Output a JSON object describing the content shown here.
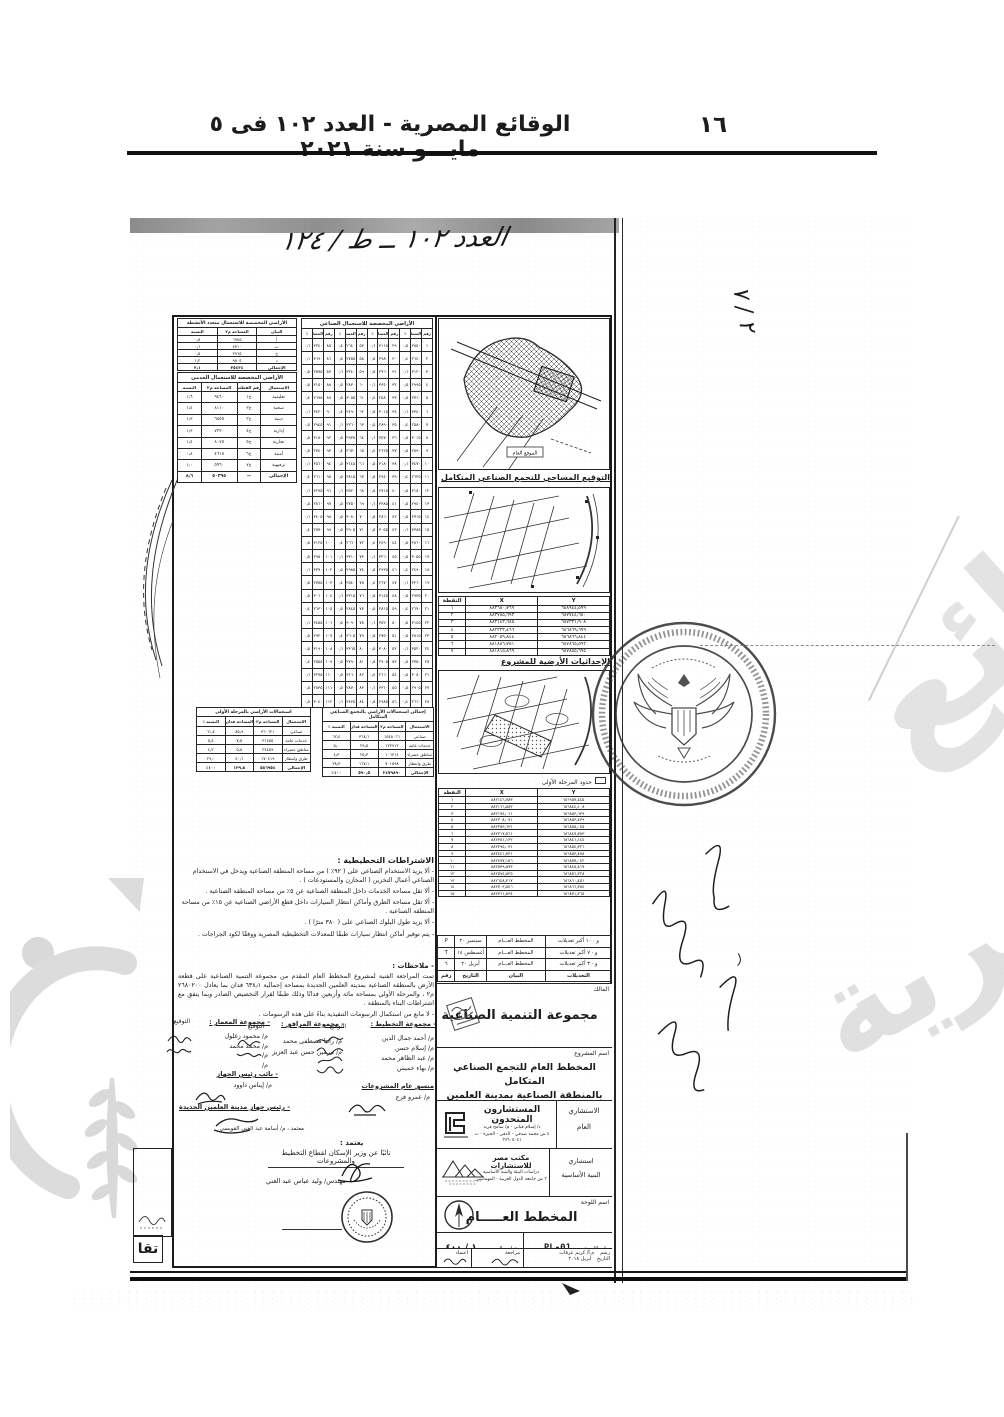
{
  "header": {
    "gazette_line": "الوقائع المصرية - العدد ١٠٢ فى ٥ مايـــو سنة ٢٠٢١",
    "page_number": "١٦"
  },
  "annotations": {
    "top_handwriting": "العدد ١٠٢ ــ ط / ١٢٤",
    "corner_mark": "٢ / ٧",
    "bottom_left_label": "تقا",
    "approved_note": "معتمد ، م/ أسامة عبد الغني القويسي"
  },
  "colors": {
    "ink": "#1c1c1c",
    "watermark": "#dedede",
    "scan_band": "#8e8e8e"
  },
  "maps": {
    "map1_caption": "التوقيع المساحي للتجمع الصناعي المتكامل",
    "map1_inner_label": "الموقع العام",
    "map2_caption": "الإحداثيات الأرضية للمشروع",
    "phase_label": "حدود المرحلة الأولى"
  },
  "coords_table1": {
    "widths": [
      "42",
      "42",
      "16"
    ],
    "headers": [
      "Y",
      "X",
      "النقطة"
    ],
    "rows": [
      [
        "٦٨٨٩٤٤٫٥٩٩",
        "٨٨٣٦٨٠٫٧٦٩",
        "١"
      ],
      [
        "٦٨٧٧٤٤٫٦٨٠",
        "٨٨٣٧٨٥٫٦٩٣",
        "٢"
      ],
      [
        "٦٨٧٣٣١٫٩٠٨",
        "٨٨٣١٤٣٫٦٨٥",
        "٣"
      ],
      [
        "٦٨٦٨٦٩٫٦٩٩",
        "٨٨٢٣٣٣٫٤٦٦",
        "٤"
      ],
      [
        "٦٨٦٨٦٦٫٨٤٤",
        "٨٨٢٠٥٩٫٨٤٤",
        "٥"
      ],
      [
        "٦٨٧٨٦٥٫٥٩٢",
        "٨٨١٨٨٦٫٧٥١",
        "٦"
      ],
      [
        "٦٨٧٨٥٥٫٦٩٥",
        "٨٨١٨١٥٫٨٦٩",
        "٧"
      ]
    ]
  },
  "coords_table2": {
    "widths": [
      "42",
      "42",
      "16"
    ],
    "headers": [
      "Y",
      "X",
      "النقطة"
    ],
    "rows": [
      [
        "٦٨٦٩٥٧٫٤٤٥",
        "٨٨٢١٤٦٫٧٨٣",
        "١"
      ],
      [
        "٦٨٦٨٤٤٫١٠٨",
        "٨٨٢١٦٦٫٥٨٢",
        "٢"
      ],
      [
        "٦٨٦٨٥٣٫٦٣٩",
        "٨٨٢١٧٤٫٠٦١",
        "٣"
      ],
      [
        "٦٨٦٨٥٣٫٤٣٩",
        "٨٨٢٢٠٨٫٠٧١",
        "٤"
      ],
      [
        "٦٨٦٨٥٥٫٠٤٥",
        "٨٨٢٢٥٣٫٦٣١",
        "٥"
      ],
      [
        "٦٨٦٨٤٧٫٧٨٣",
        "٨٨٢٣١٧٫٥٦١",
        "٦"
      ],
      [
        "٦٨٦٨٤٦٫١٤٤",
        "٨٨٢٣٥١٫١٣٢",
        "٧"
      ],
      [
        "٦٨٦٨٥٤٫٣٢٦",
        "٨٨٢٣٩٥٫٠٣١",
        "٨"
      ],
      [
        "٦٨٦٨٥٣٫٤٧٨",
        "٨٨٢٤٤١٫٧٣١",
        "٩"
      ],
      [
        "٦٨٦٨٥٧٫٠٤٢",
        "٨٨٢٤٧٧٫١٥٦",
        "١٠"
      ],
      [
        "٦٨٦٨٤٥٫٤١٧",
        "٨٨٢٥٣٩٫٨٧٣",
        "١١"
      ],
      [
        "٦٨٦٨٥٦٫٢٢٨",
        "٨٨٢٥٩٤٫٨٢٥",
        "١٢"
      ],
      [
        "٦٨٦٨٦٠٫٤٥١",
        "٨٨٢٦٤٨٫٣١٧",
        "١٣"
      ],
      [
        "٦٨٦٨٦٦٫٣٨٤",
        "٨٨٢٧٠٣٫٥٤٦",
        "١٤"
      ],
      [
        "٦٨٦٨٧١٫٢٦٥",
        "٨٨٢٧٦١٫٨٣٤",
        "١٥"
      ]
    ]
  },
  "industrial_table": {
    "title": "الأراضي المخصصة للاستعمال الصناعي",
    "headers": [
      "رقم",
      "المساحة",
      "٪",
      "رقم",
      "المساحة",
      "٪",
      "رقم",
      "المساحة",
      "٪",
      "رقم",
      "المساحة",
      "٪"
    ],
    "rows": [
      [
        "١",
        "٢٨٥٠",
        "٠٫٥",
        "٢٩",
        "٣١١٥",
        "٠٫٦",
        "٥٧",
        "٢٦٤٠",
        "٠٫٤",
        "٨٥",
        "٣٢٤٠",
        "٠٫٦"
      ],
      [
        "٢",
        "٢٦٤٠",
        "٠٫٤",
        "٣٠",
        "٢٩٨٠",
        "٠٫٥",
        "٥٨",
        "٢٧٥٥",
        "٠٫٥",
        "٨٦",
        "٣٦٩٠",
        "٠٫٦"
      ],
      [
        "٣",
        "٣١٢٠",
        "٠٫٦",
        "٣١",
        "٢٧٦٠",
        "٠٫٥",
        "٥٩",
        "٣٢٤٠",
        "٠٫٦",
        "٨٧",
        "٢٨٧٥",
        "٠٫٥"
      ],
      [
        "٤",
        "٢٩٩٥",
        "٠٫٥",
        "٣٢",
        "٣٣٤٠",
        "٠٫٦",
        "٦٠",
        "٢٨٣٠",
        "٠٫٥",
        "٨٨",
        "٣١٥٠",
        "٠٫٥"
      ],
      [
        "٥",
        "٢٧٦٠",
        "٠٫٥",
        "٣٣",
        "٢٥٨٠",
        "٠٫٤",
        "٦١",
        "٣٠٥٥",
        "٠٫٥",
        "٨٩",
        "٢٦٩٥",
        "٠٫٤"
      ],
      [
        "٦",
        "٣٣٤٠",
        "٠٫٦",
        "٣٤",
        "٣٠١٥",
        "٠٫٥",
        "٦٢",
        "٢٤٩٠",
        "٠٫٤",
        "٩٠",
        "٣٤٢٠",
        "٠٫٦"
      ],
      [
        "٧",
        "٢٥٨٠",
        "٠٫٤",
        "٣٥",
        "٢٨٩٠",
        "٠٫٥",
        "٦٣",
        "٣٢٦٠",
        "٠٫٦",
        "٩١",
        "٢٩٤٥",
        "٠٫٥"
      ],
      [
        "٨",
        "٣٠١٥",
        "٠٫٥",
        "٣٦",
        "٣٤٧٠",
        "٠٫٦",
        "٦٤",
        "٢٩٣٥",
        "٠٫٥",
        "٩٢",
        "٣١٨٠",
        "٠٫٥"
      ],
      [
        "٩",
        "٢٨٩٠",
        "٠٫٥",
        "٣٧",
        "٢٦٢٥",
        "٠٫٤",
        "٦٥",
        "٢٦٧٠",
        "٠٫٤",
        "٩٣",
        "٢٧٤٠",
        "٠٫٥"
      ],
      [
        "١٠",
        "٣٤٧٠",
        "٠٫٦",
        "٣٨",
        "٣١٨٠",
        "٠٫٥",
        "٦٦",
        "٣١٤٥",
        "٠٫٥",
        "٩٤",
        "٣٥٦٠",
        "٠٫٦"
      ],
      [
        "١١",
        "٢٦٢٥",
        "٠٫٤",
        "٣٩",
        "٢٩٤٠",
        "٠٫٥",
        "٦٧",
        "٢٨١٥",
        "٠٫٥",
        "٩٥",
        "٢٦١٠",
        "٠٫٤"
      ],
      [
        "١٢",
        "٣١٨٠",
        "٠٫٥",
        "٤٠",
        "٢٧١٥",
        "٠٫٥",
        "٦٨",
        "٣٥٢٠",
        "٠٫٦",
        "٩٦",
        "٣٢٩٥",
        "٠٫٦"
      ],
      [
        "١٣",
        "٢٩٤٠",
        "٠٫٥",
        "٤١",
        "٣٣٨٥",
        "٠٫٦",
        "٦٩",
        "٢٧٥٠",
        "٠٫٥",
        "٩٧",
        "٢٨٦٠",
        "٠٫٥"
      ],
      [
        "١٤",
        "٢٧١٥",
        "٠٫٥",
        "٤٢",
        "٢٨٦٠",
        "٠٫٥",
        "٧٠",
        "٣٠٨٠",
        "٠٫٥",
        "٩٨",
        "٣٤٠٥",
        "٠٫٦"
      ],
      [
        "١٥",
        "٣٣٨٥",
        "٠٫٦",
        "٤٣",
        "٣٠٥٥",
        "٠٫٥",
        "٧١",
        "٢٩٠٥",
        "٠٫٥",
        "٩٩",
        "٢٥٧٠",
        "٠٫٤"
      ],
      [
        "١٦",
        "٢٨٦٠",
        "٠٫٥",
        "٤٤",
        "٢٤٩٠",
        "٠٫٤",
        "٧٢",
        "٢٦٦٠",
        "٠٫٤",
        "١٠٠",
        "٣١٢٥",
        "٠٫٥"
      ],
      [
        "١٧",
        "٣٠٥٥",
        "٠٫٥",
        "٤٥",
        "٣٢٦٠",
        "٠٫٦",
        "٧٣",
        "٣٣١٠",
        "٠٫٦",
        "١٠١",
        "٢٩٥٠",
        "٠٫٥"
      ],
      [
        "١٨",
        "٢٤٩٠",
        "٠٫٤",
        "٤٦",
        "٢٩٣٥",
        "٠٫٥",
        "٧٤",
        "٢٩٨٥",
        "٠٫٥",
        "١٠٢",
        "٣٣٧٠",
        "٠٫٦"
      ],
      [
        "١٩",
        "٣٢٦٠",
        "٠٫٦",
        "٤٧",
        "٢٦٧٠",
        "٠٫٤",
        "٧٥",
        "٢٥٤٠",
        "٠٫٤",
        "١٠٣",
        "٢٧٨٥",
        "٠٫٥"
      ],
      [
        "٢٠",
        "٢٩٣٥",
        "٠٫٥",
        "٤٨",
        "٣١٤٥",
        "٠٫٥",
        "٧٦",
        "٣٢١٥",
        "٠٫٦",
        "١٠٤",
        "٣٠٦٠",
        "٠٫٥"
      ],
      [
        "٢١",
        "٢٦٧٠",
        "٠٫٤",
        "٤٩",
        "٢٨١٥",
        "٠٫٥",
        "٧٧",
        "٢٨٤٥",
        "٠٫٥",
        "١٠٥",
        "٢٦٣٠",
        "٠٫٤"
      ],
      [
        "٢٢",
        "٣١٤٥",
        "٠٫٥",
        "٥٠",
        "٣٥٢٠",
        "٠٫٦",
        "٧٨",
        "٣٠٩٠",
        "٠٫٥",
        "١٠٦",
        "٣٤٥٥",
        "٠٫٦"
      ],
      [
        "٢٣",
        "٢٨١٥",
        "٠٫٥",
        "٥١",
        "٢٧٥٠",
        "٠٫٥",
        "٧٩",
        "٢٦٠٥",
        "٠٫٤",
        "١٠٧",
        "٢٩٢٠",
        "٠٫٥"
      ],
      [
        "٢٤",
        "٣٥٢٠",
        "٠٫٦",
        "٥٢",
        "٣٠٨٠",
        "٠٫٥",
        "٨٠",
        "٣٣٦٥",
        "٠٫٦",
        "١٠٨",
        "٣١٩٠",
        "٠٫٥"
      ],
      [
        "٢٥",
        "٢٧٥٠",
        "٠٫٥",
        "٥٣",
        "٢٩٠٥",
        "٠٫٥",
        "٨١",
        "٢٧٩٠",
        "٠٫٥",
        "١٠٩",
        "٢٥٥٥",
        "٠٫٤"
      ],
      [
        "٢٦",
        "٣٠٨٠",
        "٠٫٥",
        "٥٤",
        "٢٦٦٠",
        "٠٫٤",
        "٨٢",
        "٣١٦٠",
        "٠٫٥",
        "١١٠",
        "٣٢٧٥",
        "٠٫٦"
      ],
      [
        "٢٧",
        "٢٩٠٥",
        "٠٫٥",
        "٥٥",
        "٣٣١٠",
        "٠٫٦",
        "٨٣",
        "٢٨٧٠",
        "٠٫٥",
        "١١١",
        "٢٨٣٥",
        "٠٫٥"
      ],
      [
        "٢٨",
        "٢٦٦٠",
        "٠٫٤",
        "٥٦",
        "٢٩٨٥",
        "٠٫٥",
        "٨٤",
        "٣٤٣٥",
        "٠٫٦",
        "١١٢",
        "٣٠٤٠",
        "٠٫٥"
      ]
    ]
  },
  "multi_use_table": {
    "title": "الأراضي المخصصة للاستعمال متعدد الأنشطة",
    "headers": [
      "البيان",
      "المساحة م٢",
      "النسبة"
    ],
    "rows": [
      [
        "أ",
        "٦٩٤٥",
        "٠٫٨"
      ],
      [
        "ب",
        "٤٧١٠",
        "٠٫٦"
      ],
      [
        "ج",
        "٣٩٦٥",
        "٠٫٥"
      ],
      [
        "د",
        "٩٨٠٤",
        "١٫٢"
      ]
    ],
    "footer": [
      "الإجمالي",
      "٢٥٤٢٤",
      "٣٫١"
    ]
  },
  "services_table": {
    "title": "الأراضي المخصصة للاستعمال الخدمي",
    "widths": [
      "30",
      "20",
      "30",
      "20"
    ],
    "headers": [
      "الاستعمال",
      "رقم القطعة",
      "المساحة م٢",
      "النسبة"
    ],
    "rows": [
      [
        "تعليمية",
        "خ١",
        "٩٤٦٠",
        "١٫٦"
      ],
      [
        "صحية",
        "خ٢",
        "٨١١٠",
        "١٫٤"
      ],
      [
        "دينية",
        "خ٣",
        "٦٨٥٥",
        "١٫٢"
      ],
      [
        "إدارية",
        "خ٤",
        "٧٣٢٠",
        "١٫٢"
      ],
      [
        "تجارية",
        "خ٥",
        "٨٠٧٥",
        "١٫٤"
      ],
      [
        "أمنية",
        "خ٦",
        "٤٦١٥",
        "٠٫٨"
      ],
      [
        "ترفيهية",
        "خ٧",
        "٥٩٦٠",
        "١٫٠"
      ]
    ],
    "footer": [
      "الإجمالي",
      "—",
      "٥٠٣٩٥",
      "٨٫٦"
    ]
  },
  "totals_table": {
    "title": "إجمالي استعمالات الأراضي بالتجمع الصناعي المتكامل",
    "headers": [
      "الاستعمال",
      "المساحة م٢",
      "المساحة فدان",
      "النسبة ٪"
    ],
    "rows": [
      [
        "صناعي",
        "١٥٤٨٠٦٦",
        "٣٦٨٫٦",
        "٦٢٫٤"
      ],
      [
        "خدمات عامة",
        "١٢٣٩١٢",
        "٢٩٫٥",
        "٥٫٠"
      ],
      [
        "مناطق خضراء",
        "١٠٦٣١٤",
        "٢٥٫٣",
        "٤٫٣"
      ],
      [
        "طرق وانتظار",
        "٧٠١٥٩٨",
        "١٦٧٫١",
        "٢٨٫٣"
      ]
    ],
    "footer": [
      "الإجمالي",
      "٢٤٧٩٨٩٠",
      "٥٩٠٫٥",
      "١٠٠٪"
    ]
  },
  "phase1_table": {
    "title": "استعمالات الأراضي بالمرحلة الأولى",
    "headers": [
      "الاستعمال",
      "المساحة م٢",
      "المساحة فدان",
      "النسبة ٪"
    ],
    "rows": [
      [
        "صناعي",
        "٣٦٠٦٢١",
        "٨٥٫٩",
        "٦١٫٤"
      ],
      [
        "خدمات عامة",
        "٣١٤٥٥",
        "٧٫٥",
        "٥٫٤"
      ],
      [
        "مناطق خضراء",
        "٢٤٤٥٩",
        "٥٫٨",
        "٤٫٢"
      ],
      [
        "طرق وانتظار",
        "١٧٠٤١٩",
        "٤٠٫٦",
        "٢٩٫٠"
      ]
    ],
    "footer": [
      "الإجمالي",
      "٥٨٦٩٥٤",
      "١٣٩٫٨",
      "١٠٠٪"
    ]
  },
  "requirements": {
    "title": "الاشتراطات التخطيطية :",
    "items": [
      "- ألا يزيد الاستخدام الصناعي على ( ٩٢٪ ) من مساحة المنطقة الصناعية ويدخل في الاستخدام الصناعي أعمال التخزين ( المخازن والمستودعات ) .",
      "- ألا تقل مساحة الخدمات داخل المنطقة الصناعية عن ٥٪ من مساحة المنطقة الصناعية .",
      "- ألا تقل مساحة الطرق وأماكن انتظار السيارات داخل قطع الأراضي الصناعية عن ١٥٪ من مساحة المنطقة الصناعية .",
      "- ألا يزيد طول البلوك الصناعي على ( ٣٨٠ مترًا ) .",
      "- يتم توفير أماكن انتظار سيارات طبقًا للمعدلات التخطيطية المصرية ووفقًا لكود الجراجات ."
    ]
  },
  "notes": {
    "label": "- ملاحظات :",
    "paragraph": "تمت المراجعة الفنية لمشروع المخطط العام المقدم من مجموعة التنمية الصناعية على قطعة الأرض بالمنطقة الصناعية بمدينة العلمين الجديدة بمساحة إجمالية ٦٣٨٫١ فدان بما يعادل ٢٦٨٠٢٠٠ م٢ ، والمرحلة الأولى بمساحة مائة وأربعين فدانًا وذلك طبقًا لقرار التخصيص الصادر وبما يتفق مع اشتراطات البناء بالمنطقة .",
    "final_line": "- لا مانع من استكمال الرسومات التنفيذية بناءً على هذه الرسومات ."
  },
  "signatures": {
    "sig_label": "التوقيع",
    "groups": [
      {
        "title": "- مجموعة التخطيط :",
        "names": [
          "م/ أحمد جمال الدين",
          "م/ إسلام حسن",
          "م/ عبد الظاهر محمد",
          "م/ بهاء خميس"
        ]
      },
      {
        "title": "- مجموعة المرافق :",
        "names": [
          "م/ رانيا مصطفى محمد",
          "م/ نيرمين حسن عبد العزيز"
        ]
      },
      {
        "title": "- مجموعة المعمار :",
        "names": [
          "م/ محمود زغلول",
          "م/ محمد محمد",
          "م/",
          "م/"
        ]
      }
    ],
    "coordinator_title": "منسق عام المشروعات",
    "coordinator_name": "م/ عمرو فرج",
    "deputy_title": "- نائب رئيس الجهاز",
    "deputy_name": "م/ إيناس داوود",
    "head_title": "- رئيس جهاز مدينة العلمين الجديدة",
    "accredit_label": "يعتمد :",
    "accredit_title": "نائبًا عن وزير الإسكان لقطاع التخطيط والمشروعات",
    "accredit_name": "مهندس/ وليد عباس عبد الغني"
  },
  "title_block": {
    "revisions": {
      "widths": [
        "38",
        "34",
        "18",
        "10"
      ],
      "rows": [
        [
          "و · ١٠ أكبر تعديلات",
          "المخطط العـــام",
          "سبتمبر ٢٠",
          "P"
        ],
        [
          "و · ٧ أكبر تعديلات",
          "المخطط العـــام",
          "أغسطس ١٤",
          "T"
        ],
        [
          "و · ٣ أكبر تعديلات",
          "المخطط العـــام",
          "أبريل ٢٠",
          "٦"
        ]
      ],
      "footer": [
        "التعديلات",
        "البيان",
        "التاريخ",
        "رقم"
      ]
    },
    "owner_label": "المالك",
    "owner_name": "مجموعة التنمية الصناعية",
    "project_label": "اسم المشروع",
    "project_line1": "المخطط العام للتجمع الصناعي المتكامل",
    "project_line2": "بالمنطقة الصناعية بمدينة العلمين الجديدة",
    "cg_label1": "الاستشاري",
    "cg_label2": "العام",
    "cg_name": "المستشارون المتحدون",
    "cg_sub1": "د/ إسلام قباني - م/ سامح فريد",
    "cg_sub2": "٤ ش محمد صدقي - الدقي - الجيزة - ت ٣٧٦٠٥٠٤١",
    "ci_label1": "استشاري",
    "ci_label2": "البنية الأساسية",
    "ci_name": "مكتب مصر للاستشارات",
    "ci_sub1": "دراسات البيئة والبنية الأساسية",
    "ci_sub2": "٣ ش جامعة الدول العربية - المهندسين",
    "sheet_label": "اسم اللوحة",
    "sheet_name": "المخطط العـــــام",
    "sheet_no_label": "رقم اللوحة",
    "sheet_no": "PL-01",
    "scale_label": "مقياس الرسم",
    "scale": "١ / ٤٠٠",
    "drawn_label": "رسم",
    "drawn_by": "م.أ/ كريم عرفات",
    "date_label": "التاريخ",
    "date": "أبريل ٢٠١٨",
    "review_label": "مراجعة",
    "approve_label": "اعتماد"
  }
}
